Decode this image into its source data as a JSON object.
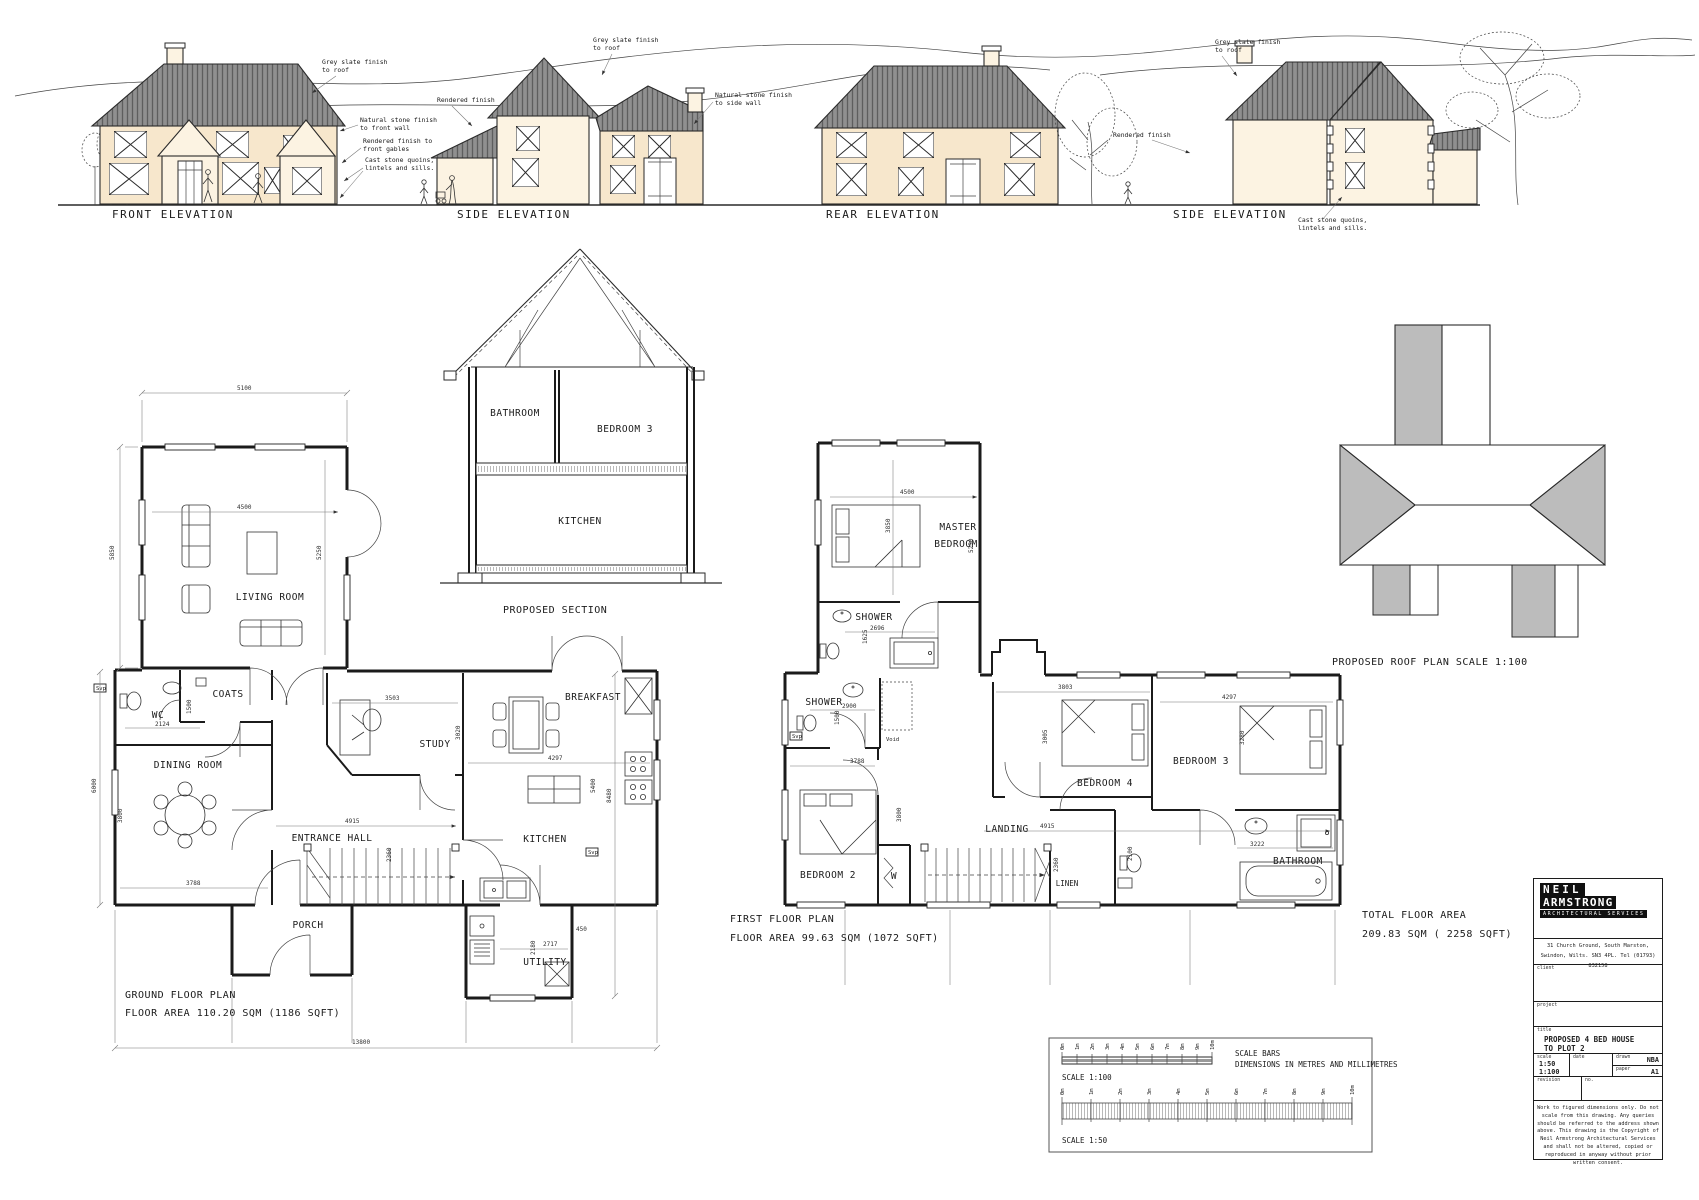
{
  "colors": {
    "stone_wall": "#f7e7cc",
    "rendered_wall": "#fcf3e2",
    "roof_grey": "#8f8f8f",
    "roof_plan_grey": "#bcbcbc",
    "line": "#222222"
  },
  "elevations": {
    "labels": [
      "FRONT ELEVATION",
      "SIDE ELEVATION",
      "REAR ELEVATION",
      "SIDE ELEVATION"
    ],
    "annotations": [
      {
        "l1": "Grey slate finish",
        "l2": "to roof"
      },
      {
        "l1": "Natural stone finish",
        "l2": "to front wall"
      },
      {
        "l1": "Rendered finish to",
        "l2": "front gables"
      },
      {
        "l1": "Cast stone quoins,",
        "l2": "lintels and sills."
      },
      {
        "l1": "Rendered finish",
        "l2": ""
      },
      {
        "l1": "Grey slate finish",
        "l2": "to roof"
      },
      {
        "l1": "Natural stone finish",
        "l2": "to side wall"
      },
      {
        "l1": "Rendered finish",
        "l2": ""
      },
      {
        "l1": "Grey slate finish",
        "l2": "to roof"
      },
      {
        "l1": "Cast stone quoins,",
        "l2": "lintels and sills."
      }
    ]
  },
  "section": {
    "label": "PROPOSED SECTION",
    "rooms": {
      "bathroom": "BATHROOM",
      "bedroom3": "BEDROOM 3",
      "kitchen": "KITCHEN"
    }
  },
  "ground": {
    "title": "GROUND FLOOR PLAN",
    "area": "FLOOR AREA 110.20 SQM (1186 SQFT)",
    "svp": "Svp",
    "rooms": {
      "living": "LIVING ROOM",
      "wc": "WC",
      "coats": "COATS",
      "dining": "DINING ROOM",
      "study": "STUDY",
      "breakfast": "BREAKFAST",
      "kitchen": "KITCHEN",
      "hall": "ENTRANCE HALL",
      "porch": "PORCH",
      "utility": "UTILITY"
    },
    "dims": {
      "t5100": "5100",
      "l5850": "5850",
      "i4500": "4500",
      "r5250": "5250",
      "l6000": "6000",
      "wc2124": "2124",
      "wc1500": "1500",
      "d3800": "3800",
      "d3788": "3788",
      "s3503": "3503",
      "s3020": "3020",
      "h4915": "4915",
      "h2360": "2360",
      "k4297": "4297",
      "k5400": "5400",
      "r8480": "8480",
      "u2717": "2717",
      "u2180": "2180",
      "u450": "450",
      "b13800": "13800"
    }
  },
  "first": {
    "title": "FIRST FLOOR PLAN",
    "area": "FLOOR AREA 99.63 SQM (1072 SQFT)",
    "svp": "Svp",
    "rooms": {
      "master1": "MASTER",
      "master2": "BEDROOM",
      "shower1": "SHOWER",
      "shower2": "SHOWER",
      "voidlbl": "Void",
      "bed2": "BEDROOM 2",
      "w": "W",
      "landing": "LANDING",
      "bed4": "BEDROOM 4",
      "bed3": "BEDROOM 3",
      "linen": "LINEN",
      "bathroom": "BATHROOM"
    },
    "dims": {
      "m4500": "4500",
      "m3850": "3850",
      "m5250": "5250",
      "sh2696": "2696",
      "sh1625": "1625",
      "s2900": "2900",
      "s1500": "1500",
      "b2a": "3788",
      "b2b": "3800",
      "b4a": "3803",
      "b4b": "3005",
      "b3a": "4297",
      "b3b": "3280",
      "l4915": "4915",
      "l2360": "2360",
      "ba3222": "3222",
      "ba2100": "2100"
    }
  },
  "roof_plan": {
    "label": "PROPOSED ROOF PLAN SCALE 1:100"
  },
  "totals": {
    "l1": "TOTAL FLOOR AREA",
    "l2": "209.83 SQM ( 2258 SQFT)"
  },
  "scalebars": {
    "title1": "SCALE BARS",
    "title2": "DIMENSIONS IN METRES AND MILLIMETRES",
    "label100": "SCALE 1:100",
    "label50": "SCALE 1:50",
    "ticks": [
      "0m",
      "1m",
      "2m",
      "3m",
      "4m",
      "5m",
      "6m",
      "7m",
      "8m",
      "9m",
      "10m"
    ]
  },
  "titleblock": {
    "logo1": "NEIL",
    "logo2": "ARMSTRONG",
    "logo3": "ARCHITECTURAL SERVICES",
    "addr1": "31 Church Ground, South Marston,",
    "addr2": "Swindon, Wilts. SN3 4PL. Tel (01793) 832158",
    "client_label": "client",
    "project_label": "project",
    "title_label": "title",
    "title_l1": "PROPOSED 4 BED HOUSE",
    "title_l2": "TO PLOT 2",
    "scale_label": "scale",
    "scale_v1": "1:50",
    "scale_v2": "1:100",
    "date_label": "date",
    "drawn_label": "drawn",
    "drawn_v": "NBA",
    "paper_label": "paper",
    "paper_v": "A1",
    "revision_label": "revision",
    "no_label": "no.",
    "note": "Work to figured dimensions only. Do not scale from this drawing. Any queries should be referred to the address shown above. This drawing is the Copyright of Neil Armstrong Architectural Services and shall not be altered, copied or reproduced in anyway without prior written consent."
  }
}
